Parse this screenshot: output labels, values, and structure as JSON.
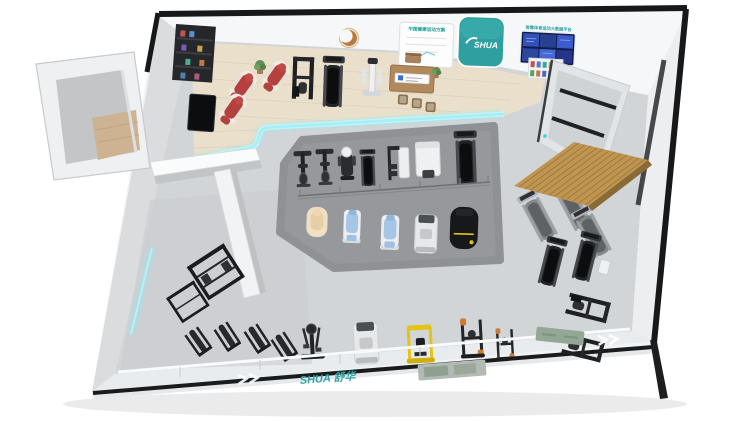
{
  "meta": {
    "render_type": "isometric-3d-floorplan",
    "subject": "SHUA smart fitness showroom floor plan"
  },
  "signage": {
    "presentation_board_title": "中国健康运动方案",
    "brand_logo": "SHUA",
    "data_screen_title": "智慧体育运动大数据平台",
    "floor_glass_logo": "SHUA 舒华"
  },
  "colors": {
    "brand_teal": "#2fa3a3",
    "led_cyan": "#8ceef8",
    "screen_blue": "#0f1c4e",
    "canopy_wood": "#c0954f",
    "machine_yellow": "#e5c312",
    "massage_chair_red": "#b5413f",
    "test_chair_blue": "#a6c6e6",
    "recliner_cream": "#f1dfc2",
    "wood_floor": "#e9dfca",
    "island_gray": "#96989b"
  },
  "zones": [
    {
      "name": "annex-storage-room"
    },
    {
      "name": "reception-experience-area"
    },
    {
      "name": "central-testing-island"
    },
    {
      "name": "canopy-treadmill-zone"
    },
    {
      "name": "strength-training-corner"
    },
    {
      "name": "bottom-cardio-strength-row"
    }
  ],
  "equipment_inventory": [
    {
      "name": "massage-chair",
      "count": 3,
      "color": "red/white"
    },
    {
      "name": "treadmill",
      "count": 7
    },
    {
      "name": "exercise-bike",
      "count": 2
    },
    {
      "name": "testing-chair",
      "count": 2,
      "color": "blue"
    },
    {
      "name": "recliner",
      "count": 1,
      "color": "cream"
    },
    {
      "name": "massage-bed",
      "count": 1,
      "color": "black/yellow"
    },
    {
      "name": "strength-machine",
      "count": 10
    },
    {
      "name": "squat-machine",
      "count": 1,
      "color": "yellow"
    },
    {
      "name": "elliptical",
      "count": 1
    },
    {
      "name": "consultation-desk",
      "count": 1
    }
  ]
}
